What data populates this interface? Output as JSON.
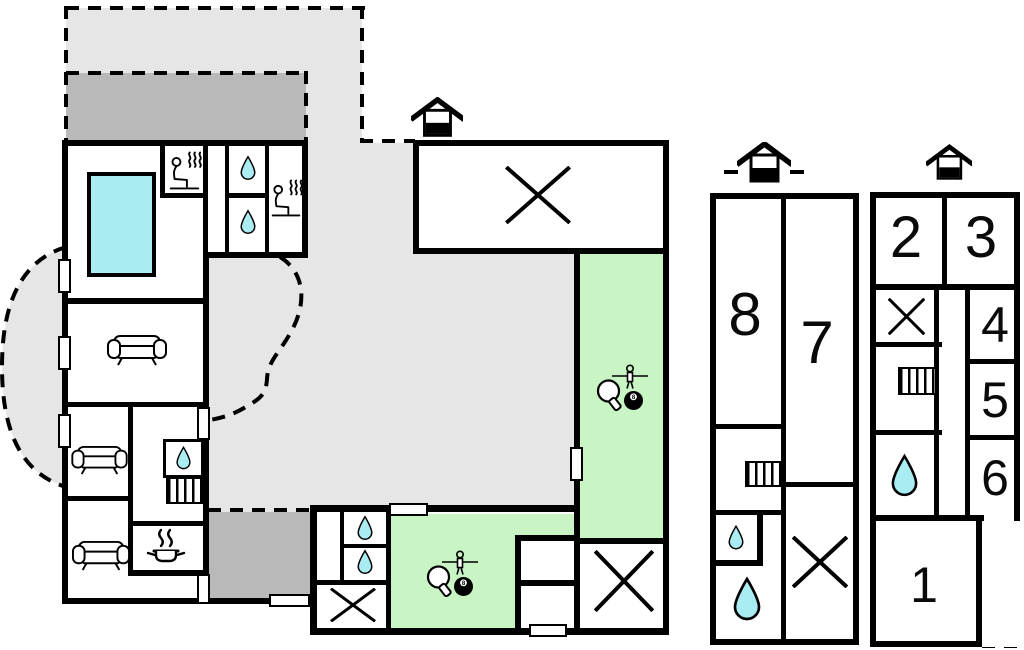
{
  "plan_title": "holiday-home-floor-plan",
  "rooms": {
    "r1": {
      "label": "1"
    },
    "r2": {
      "label": "2"
    },
    "r3": {
      "label": "3"
    },
    "r4": {
      "label": "4"
    },
    "r5": {
      "label": "5"
    },
    "r6": {
      "label": "6"
    },
    "r7": {
      "label": "7"
    },
    "r8": {
      "label": "8"
    }
  },
  "icons": {
    "eight_ball_digit": "8",
    "names": [
      "entrance-icon",
      "sauna-icon",
      "water-drop-icon",
      "sofa-icon",
      "kitchen-pot-icon",
      "stairs-icon",
      "bed-cross-icon",
      "game-room-icon",
      "swimming-pool",
      "table-tennis-paddle-icon",
      "foosball-player-icon",
      "eight-ball-icon"
    ]
  },
  "colors": {
    "wall": "#000000",
    "water_cyan": "#a9ecf2",
    "game_green": "#c9f4c4",
    "terrain_light": "#e6e6e6",
    "terrain_dark": "#b9b9b9",
    "terrace_gray": "#c6c6c6"
  }
}
